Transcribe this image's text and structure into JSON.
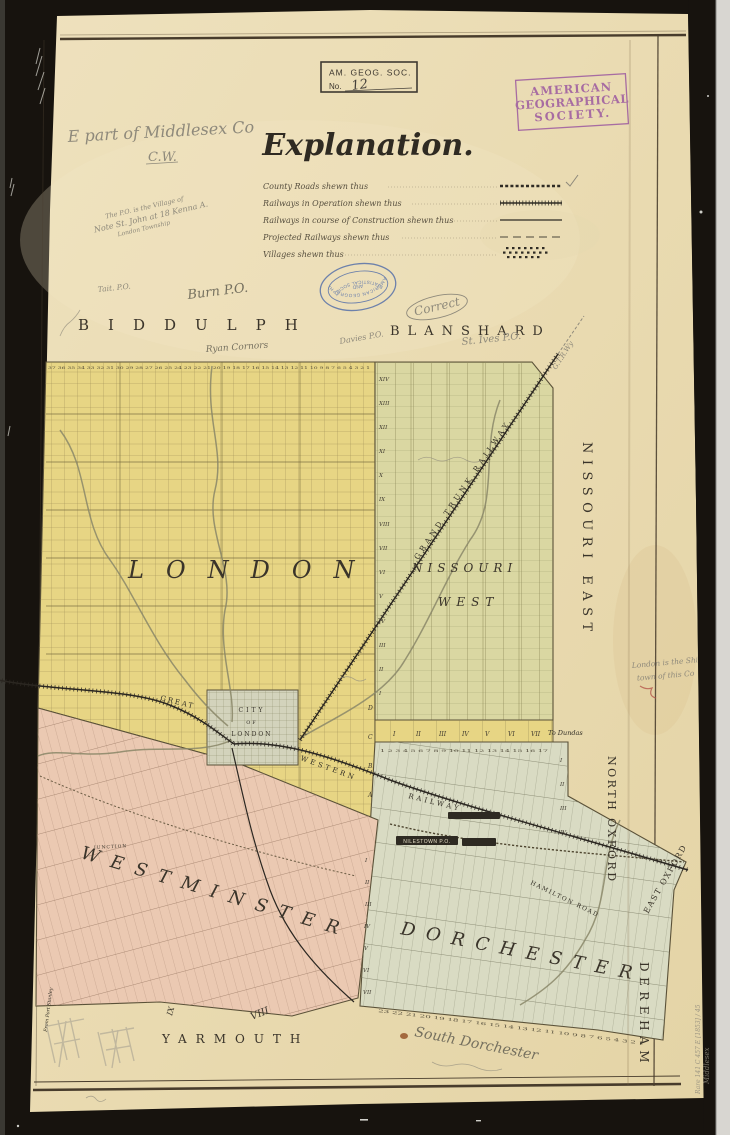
{
  "photo": {
    "background_color": "#17130e",
    "paper_color": "#eadcb4",
    "right_sliver_color": "#d8d6d1"
  },
  "stamps": {
    "accession": {
      "line1": "AM. GEOG. SOC.",
      "no_label": "No.",
      "number": "12"
    },
    "ags": {
      "line1": "AMERICAN",
      "line2": "GEOGRAPHICAL",
      "line3": "SOCIETY.",
      "color": "#9c59a0"
    },
    "oval": {
      "ring_top": "AMERICAN GEOGRAPHICAL",
      "center": "AND",
      "ring_bottom": "STATISTICAL SOCIETY",
      "color": "#4e6aa8"
    }
  },
  "legend": {
    "title": "Explanation.",
    "items": [
      {
        "label": "County Roads shewn thus",
        "style": "dotted"
      },
      {
        "label": "Railways in Operation shewn thus",
        "style": "hatched"
      },
      {
        "label": "Railways in course of Construction shewn thus",
        "style": "solid"
      },
      {
        "label": "Projected Railways shewn thus",
        "style": "dashed"
      },
      {
        "label": "Villages shewn thus",
        "style": "blocks"
      }
    ]
  },
  "townships": {
    "london": {
      "name": "LONDON",
      "color": "#e7d584"
    },
    "nissouri_west": {
      "name_line1": "NISSOURI",
      "name_line2": "WEST",
      "color": "#dad7a2"
    },
    "westminster": {
      "name": "WESTMINSTER",
      "color": "#ebc9b2"
    },
    "dorchester": {
      "name": "DORCHESTER",
      "color": "#d9dbc3"
    },
    "city": {
      "line1": "CITY",
      "line2": "OF",
      "line3": "LONDON"
    }
  },
  "margin_names": {
    "biddulph": "BIDDULPH",
    "blanshard": "BLANSHARD",
    "nissouri_east": "NISSOURI EAST",
    "north_oxford": "NORTH OXFORD",
    "east_oxford": "EAST OXFORD",
    "dereham": "DEREHAM",
    "yarmouth": "YARMOUTH"
  },
  "map_labels": {
    "great": "GREAT",
    "western": "WESTERN",
    "railway": "RAILWAY",
    "grand_trunk": "GRAND TRUNK RAILWAY",
    "to_dundas": "To Dundas",
    "nilestown": "NILESTOWN P.O.",
    "hamilton_road": "HAMILTON ROAD",
    "junction": "JUNCTION",
    "from_port_stanley": "From Port Stanley"
  },
  "numerals": {
    "london_concessions": [
      "XIV",
      "XIII",
      "XII",
      "XI",
      "X",
      "IX",
      "VIII",
      "VII",
      "VI",
      "V",
      "IV",
      "III",
      "II",
      "I"
    ],
    "city_letters": [
      "D",
      "C",
      "B",
      "A"
    ],
    "dundas_strip": [
      "I",
      "II",
      "III",
      "IV",
      "V",
      "VI",
      "VII"
    ],
    "dorchester_left": [
      "I",
      "II",
      "III",
      "IV",
      "V",
      "VI",
      "VII"
    ],
    "north_dorchester_right": [
      "I",
      "II",
      "III",
      "IV"
    ],
    "yarmouth_viii": "VIII",
    "yarmouth_ix": "IX"
  },
  "lot_rows": {
    "london_top": "37 36 35 34 33 32 31 30 29 28 27 26 25 24 23 22 21 20 19 18 17 16 15 14 13 12 11 10 9 8 7 6 5 4 3 2 1",
    "dundas": "1 2 3 4 5 6 7 8 9 10 11 12 13 14 15 16 17",
    "dorchester_bottom": "23 22 21 20 19 18 17 16 15 14 13 12 11 10 9 8 7 6 5 4 3 2 1"
  },
  "annotations": {
    "e_part": "E part of Middlesex Co",
    "cw": "C.W.",
    "note1": "The P.O. is the Village of",
    "note2": "Note  St. John at 18 Kenna A.",
    "note3": "London Township",
    "tait": "Tait. P.O.",
    "burn": "Burn P.O.",
    "ryan": "Ryan Cornors",
    "davies": "Davies P.O.",
    "correct": "Correct",
    "st_ives": "St. Ives P.O.",
    "gtr": "G.T.R.Wy",
    "shire1": "London is the Shire",
    "shire2": "town of this Co",
    "south_dorchester": "South Dorchester"
  },
  "catalog": {
    "line1": "Rare 141 C 457 E [1853] / 45",
    "line2": "Middlesex"
  }
}
